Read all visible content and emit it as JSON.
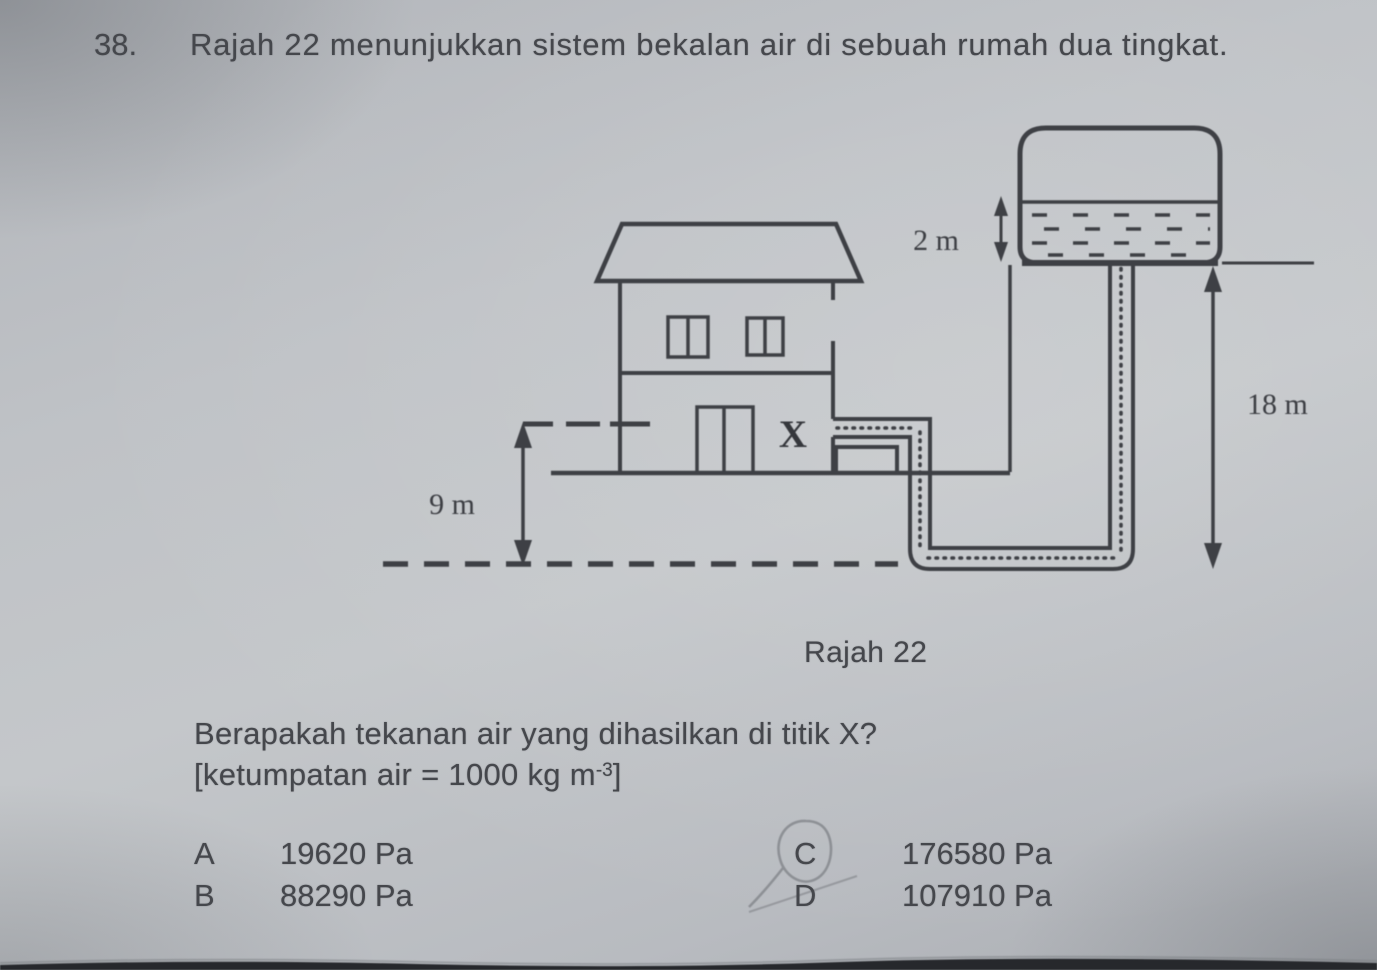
{
  "question": {
    "number": "38.",
    "text": "Rajah 22 menunjukkan sistem bekalan air di sebuah rumah dua tingkat.",
    "prompt": "Berapakah tekanan air yang dihasilkan di titik X?",
    "given_prefix": "[ketumpatan air = 1000 kg m",
    "given_superscript": "-3",
    "given_suffix": "]"
  },
  "figure": {
    "caption": "Rajah 22",
    "labels": {
      "tank_water_depth": "2 m",
      "tank_to_ground_height": "18 m",
      "floor_height": "9 m",
      "point": "X"
    }
  },
  "options": [
    {
      "letter": "A",
      "value": "19620 Pa",
      "marked": false
    },
    {
      "letter": "B",
      "value": "88290 Pa",
      "marked": false
    },
    {
      "letter": "C",
      "value": "176580 Pa",
      "marked": true
    },
    {
      "letter": "D",
      "value": "107910 Pa",
      "marked": false
    }
  ],
  "colors": {
    "paper": "#bcc0c4",
    "ink": "#3e4045",
    "text": "#45474c",
    "pencil_mark": "#8d9095",
    "scan_edge": "#26282c"
  }
}
